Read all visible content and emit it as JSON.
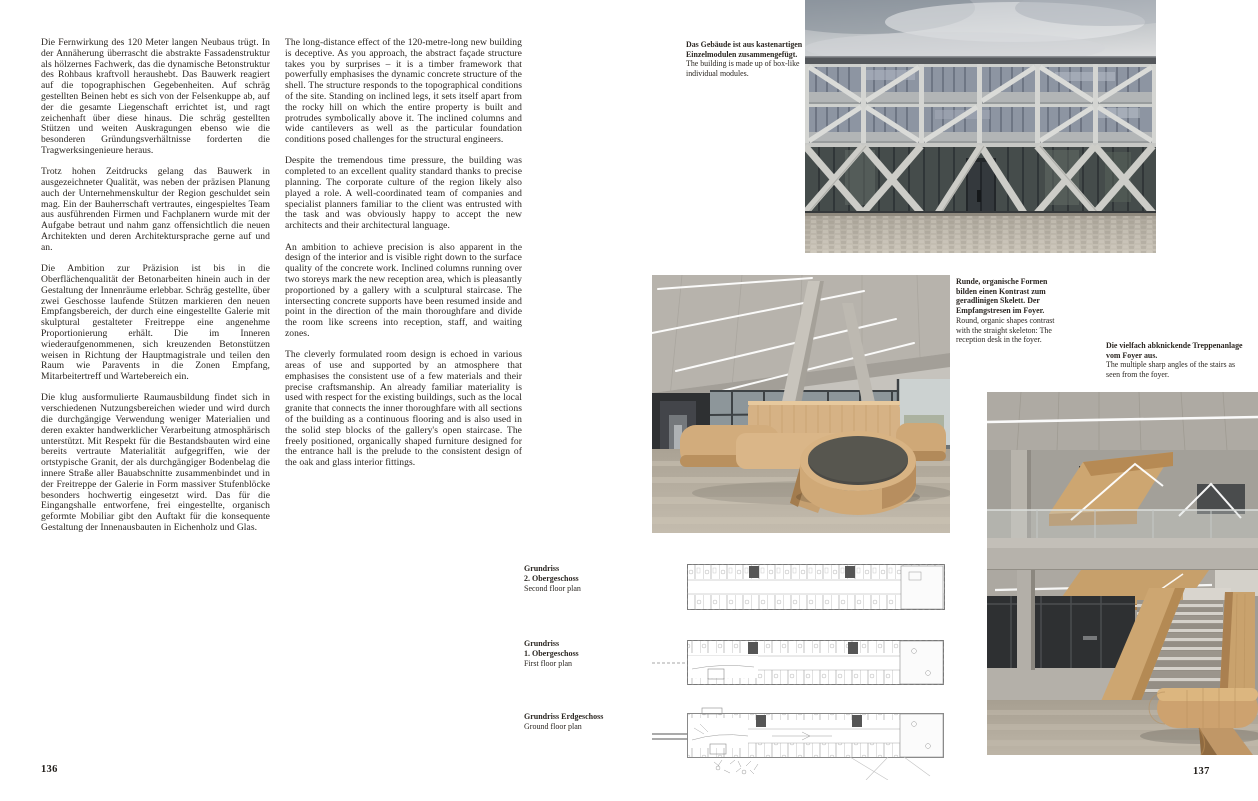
{
  "page": {
    "left_number": "136",
    "right_number": "137"
  },
  "article": {
    "german": [
      "Die Fernwirkung des 120 Meter langen Neubaus trügt. In der Annäherung überrascht die abstrakte Fassadenstruktur als hölzernes Fachwerk, das die dynamische Betonstruktur des Rohbaus kraftvoll heraushebt. Das Bauwerk reagiert auf die topographischen Gegebenheiten. Auf schräg gestellten Beinen hebt es sich von der Felsenkuppe ab, auf der die gesamte Liegenschaft errichtet ist, und ragt zeichenhaft über diese hinaus. Die schräg gestellten Stützen und weiten Auskragungen ebenso wie die besonderen Gründungsverhältnisse forderten die Tragwerksingenieure heraus.",
      "Trotz hohen Zeitdrucks gelang das Bauwerk in ausgezeichneter Qualität, was neben der präzisen Planung auch der Unternehmenskultur der Region geschuldet sein mag. Ein der Bauherrschaft vertrautes, eingespieltes Team aus ausführenden Firmen und Fachplanern wurde mit der Aufgabe betraut und nahm ganz offensichtlich die neuen Architekten und deren Architektursprache gerne auf und an.",
      "Die Ambition zur Präzision ist bis in die Oberflächenqualität der Betonarbeiten hinein auch in der Gestaltung der Innenräume erlebbar. Schräg gestellte, über zwei Geschosse laufende Stützen markieren den neuen Empfangsbereich, der durch eine eingestellte Galerie mit skulptural gestalteter Freitreppe eine angenehme Proportionierung erhält. Die im Inneren wiederaufgenommenen, sich kreuzenden Betonstützen weisen in Richtung der Hauptmagistrale und teilen den Raum wie Paravents in die Zonen Empfang, Mitarbeitertreff und Wartebereich ein.",
      "Die klug ausformulierte Raumausbildung findet sich in verschiedenen Nutzungsbereichen wieder und wird durch die durchgängige Verwendung weniger Materialien und deren exakter handwerklicher Verarbeitung atmosphärisch unterstützt. Mit Respekt für die Bestandsbauten wird eine bereits vertraute Materialität aufgegriffen, wie der ortstypische Granit, der als durchgängiger Bodenbelag die innere Straße aller Bauabschnitte zusammenbindet und in der Freitreppe der Galerie in Form massiver Stufenblöcke besonders hochwertig eingesetzt wird. Das für die Eingangshalle entworfene, frei eingestellte, organisch geformte Mobiliar gibt den Auftakt für die konsequente Gestaltung der Innenausbauten in Eichenholz und Glas."
    ],
    "english": [
      "The long-distance effect of the 120-metre-long new building is deceptive. As you approach, the abstract façade structure takes you by surprises – it is a timber framework that powerfully emphasises the dynamic concrete structure of the shell. The structure responds to the topographical conditions of the site. Standing on inclined legs, it sets itself apart from the rocky hill on which the entire property is built and protrudes symbolically above it. The inclined columns and wide cantilevers as well as the particular foundation conditions posed challenges for the structural engineers.",
      "Despite the tremendous time pressure, the building was completed to an excellent quality standard thanks to precise planning. The corporate culture of the region likely also played a role. A well-coordinated team of companies and specialist planners familiar to the client was entrusted with the task and was obviously happy to accept the new architects and their architectural language.",
      "An ambition to achieve precision is also apparent in the design of the interior and is visible right down to the surface quality of the concrete work. Inclined columns running over two storeys mark the new reception area, which is pleasantly proportioned by a gallery with a sculptural staircase. The intersecting concrete supports have been resumed inside and point in the direction of the main thoroughfare and divide the room like screens into reception, staff, and waiting zones.",
      "The cleverly formulated room design is echoed in various areas of use and supported by an atmosphere that emphasises the consistent use of a few materials and their precise craftsmanship. An already familiar materiality is used with respect for the existing buildings, such as the local granite that connects the inner thoroughfare with all sections of the building as a continuous flooring and is also used in the solid step blocks of the gallery's open staircase. The freely positioned, organically shaped furniture designed for the entrance hall is the prelude to the consistent design of the oak and glass interior fittings."
    ]
  },
  "captions": {
    "facade": {
      "de": "Das Gebäude ist aus kastenartigen Einzelmodulen zusammengefügt.",
      "en": "The building is made up of box-like individual modules."
    },
    "reception": {
      "de": "Runde, organische Formen bilden einen Kontrast zum geradlinigen Skelett. Der Empfangstresen im Foyer.",
      "en": "Round, organic shapes contrast with the straight skeleton: The reception desk in the foyer."
    },
    "stairs": {
      "de": "Die vielfach abknickende Treppenanlage vom Foyer aus.",
      "en": "The multiple sharp angles of the stairs as seen from the foyer."
    }
  },
  "plans": [
    {
      "lines": [
        "Grundriss",
        "2. Obergeschoss",
        "Second floor plan"
      ]
    },
    {
      "lines": [
        "Grundriss",
        "1. Obergeschoss",
        "First floor plan"
      ]
    },
    {
      "lines": [
        "Grundriss Erdgeschoss",
        "Ground floor plan"
      ]
    }
  ],
  "colors": {
    "paper": "#ffffff",
    "ink": "#29241f",
    "oak": "#d2ab79",
    "concrete": "#b5b1aa",
    "sky": "#b6bac0"
  }
}
